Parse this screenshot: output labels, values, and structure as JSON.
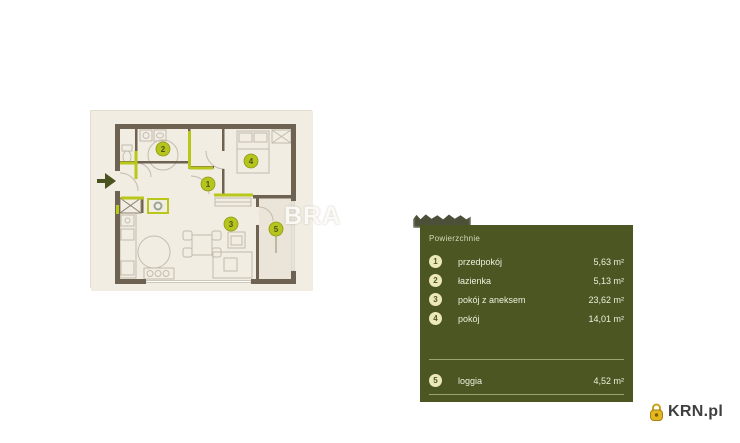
{
  "watermark": {
    "text": "BRA"
  },
  "floorplan": {
    "badges": [
      {
        "num": "1"
      },
      {
        "num": "2"
      },
      {
        "num": "3"
      },
      {
        "num": "4"
      },
      {
        "num": "5"
      }
    ],
    "colors": {
      "background": "#f1ede3",
      "wall": "#6e6253",
      "accent": "#b9c71b",
      "furniture": "#c3bcad",
      "arrow": "#4a5220"
    }
  },
  "legend": {
    "title": "Powierzchnie",
    "items": [
      {
        "num": "1",
        "label": "przedpokój",
        "area": "5,63 m²"
      },
      {
        "num": "2",
        "label": "łazienka",
        "area": "5,13 m²"
      },
      {
        "num": "3",
        "label": "pokój z aneksem",
        "area": "23,62 m²"
      },
      {
        "num": "4",
        "label": "pokój",
        "area": "14,01 m²"
      }
    ],
    "footer_item": {
      "num": "5",
      "label": "loggia",
      "area": "4,52 m²"
    },
    "colors": {
      "panel": "#4b5622",
      "badge": "#ece8ba"
    }
  },
  "logo": {
    "text": "KRN.pl",
    "icon_color": "#d9a91e"
  }
}
